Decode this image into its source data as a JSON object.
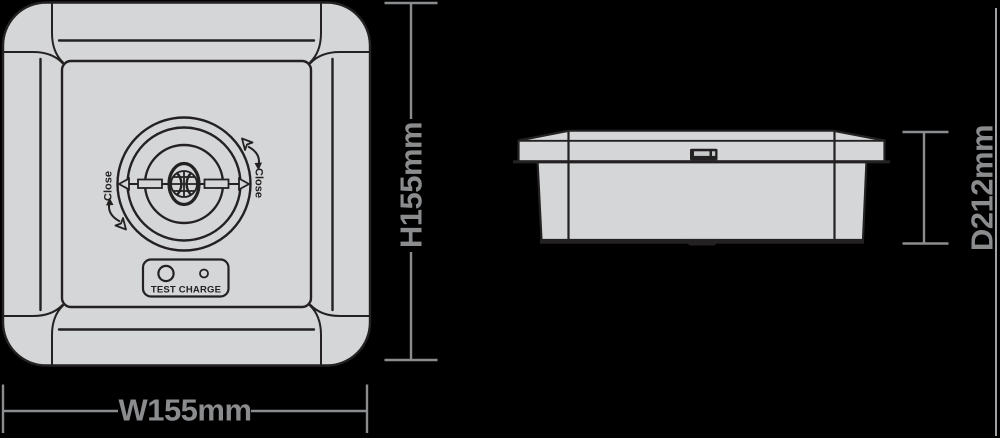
{
  "colors": {
    "background": "#000000",
    "outline": "#232122",
    "body_fill": "#d5d6d7",
    "dimension": "#8a8c8e"
  },
  "front_view": {
    "close_left_label": "Close",
    "close_right_label": "Close",
    "test_charge_label": "TEST CHARGE",
    "height_dimension": "H155mm",
    "width_dimension": "W155mm"
  },
  "side_view": {
    "depth_dimension": "D212mm"
  },
  "icons": {
    "close_rotate_arrow_top_right": "curved-arrow-open-arrowhead",
    "close_rotate_arrow_bottom_left": "curved-arrow-open-arrowhead",
    "pointer_left": "triangle-left",
    "pointer_right": "triangle-right",
    "gimbal_lamp": "lamp-sphere-symbol",
    "test_indicator": "large-circle",
    "charge_indicator": "small-circle"
  }
}
